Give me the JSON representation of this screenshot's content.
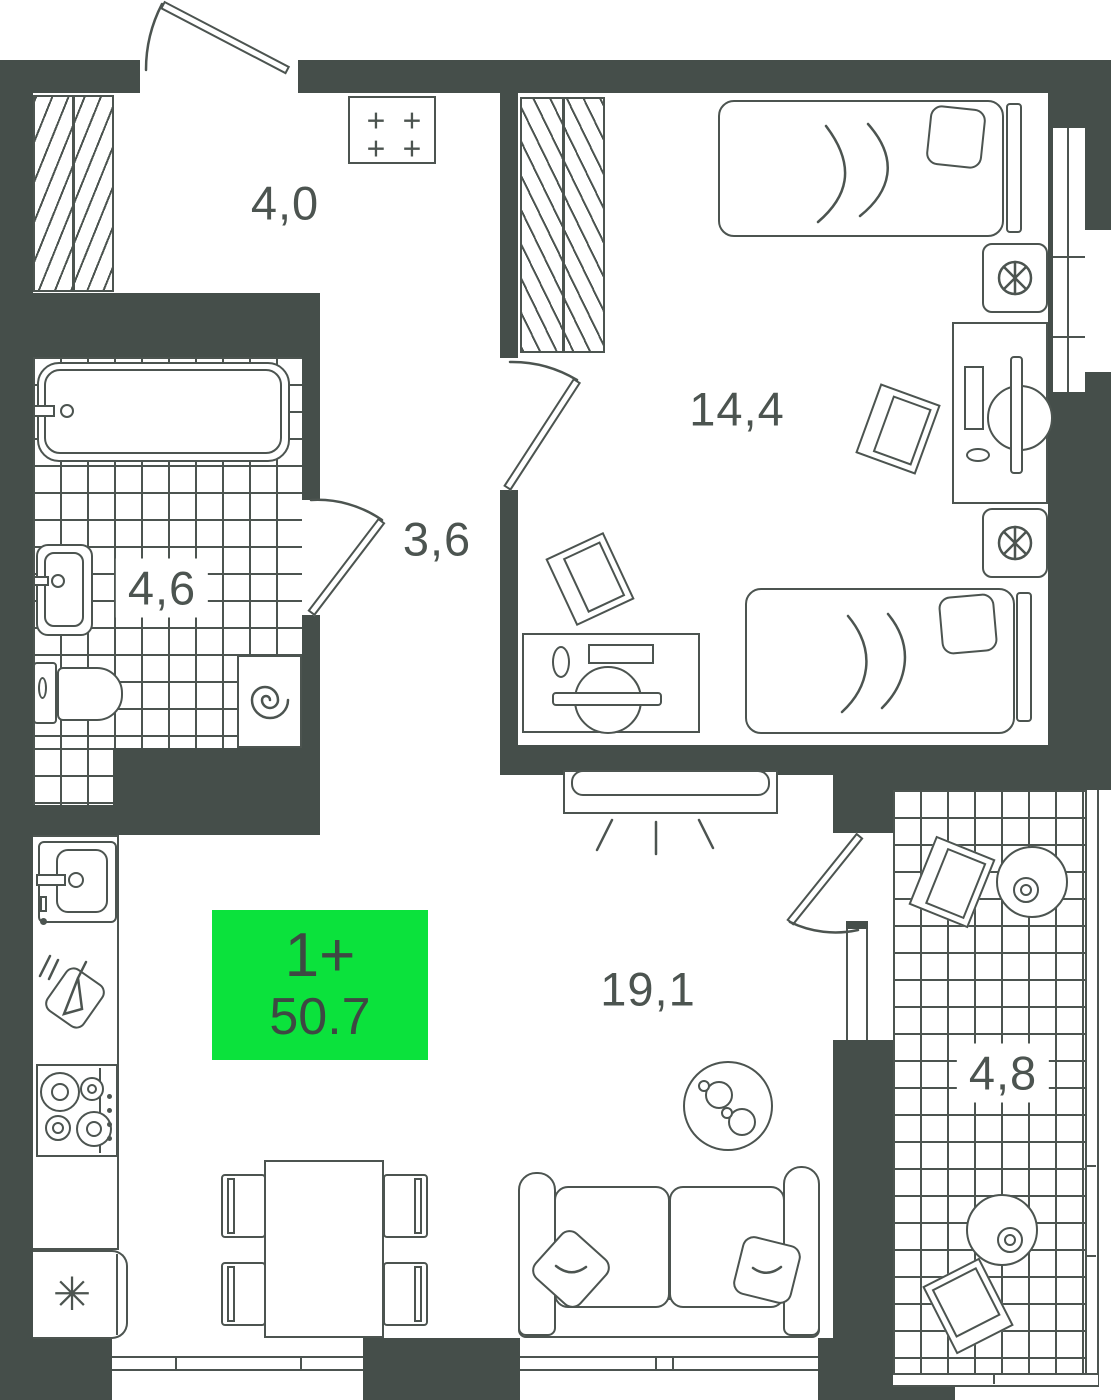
{
  "plan": {
    "badge": {
      "unit_type": "1+",
      "area": "50.7",
      "bg_color": "#0BE23C",
      "text_color": "#3E4843"
    },
    "rooms": {
      "hall": {
        "name": "hallway",
        "label": "4,0"
      },
      "bathroom": {
        "name": "bathroom",
        "label": "4,6"
      },
      "corridor": {
        "name": "corridor",
        "label": "3,6"
      },
      "bedroom": {
        "name": "bedroom",
        "label": "14,4"
      },
      "living": {
        "name": "living-kitchen",
        "label": "19,1"
      },
      "balcony": {
        "name": "balcony",
        "label": "4,8"
      }
    },
    "symbols": {
      "utility_plus": "+",
      "fridge_snowflake": "✳"
    },
    "colors": {
      "wall": "#454E4A",
      "line": "#4C5450",
      "background": "#FFFFFF"
    }
  }
}
